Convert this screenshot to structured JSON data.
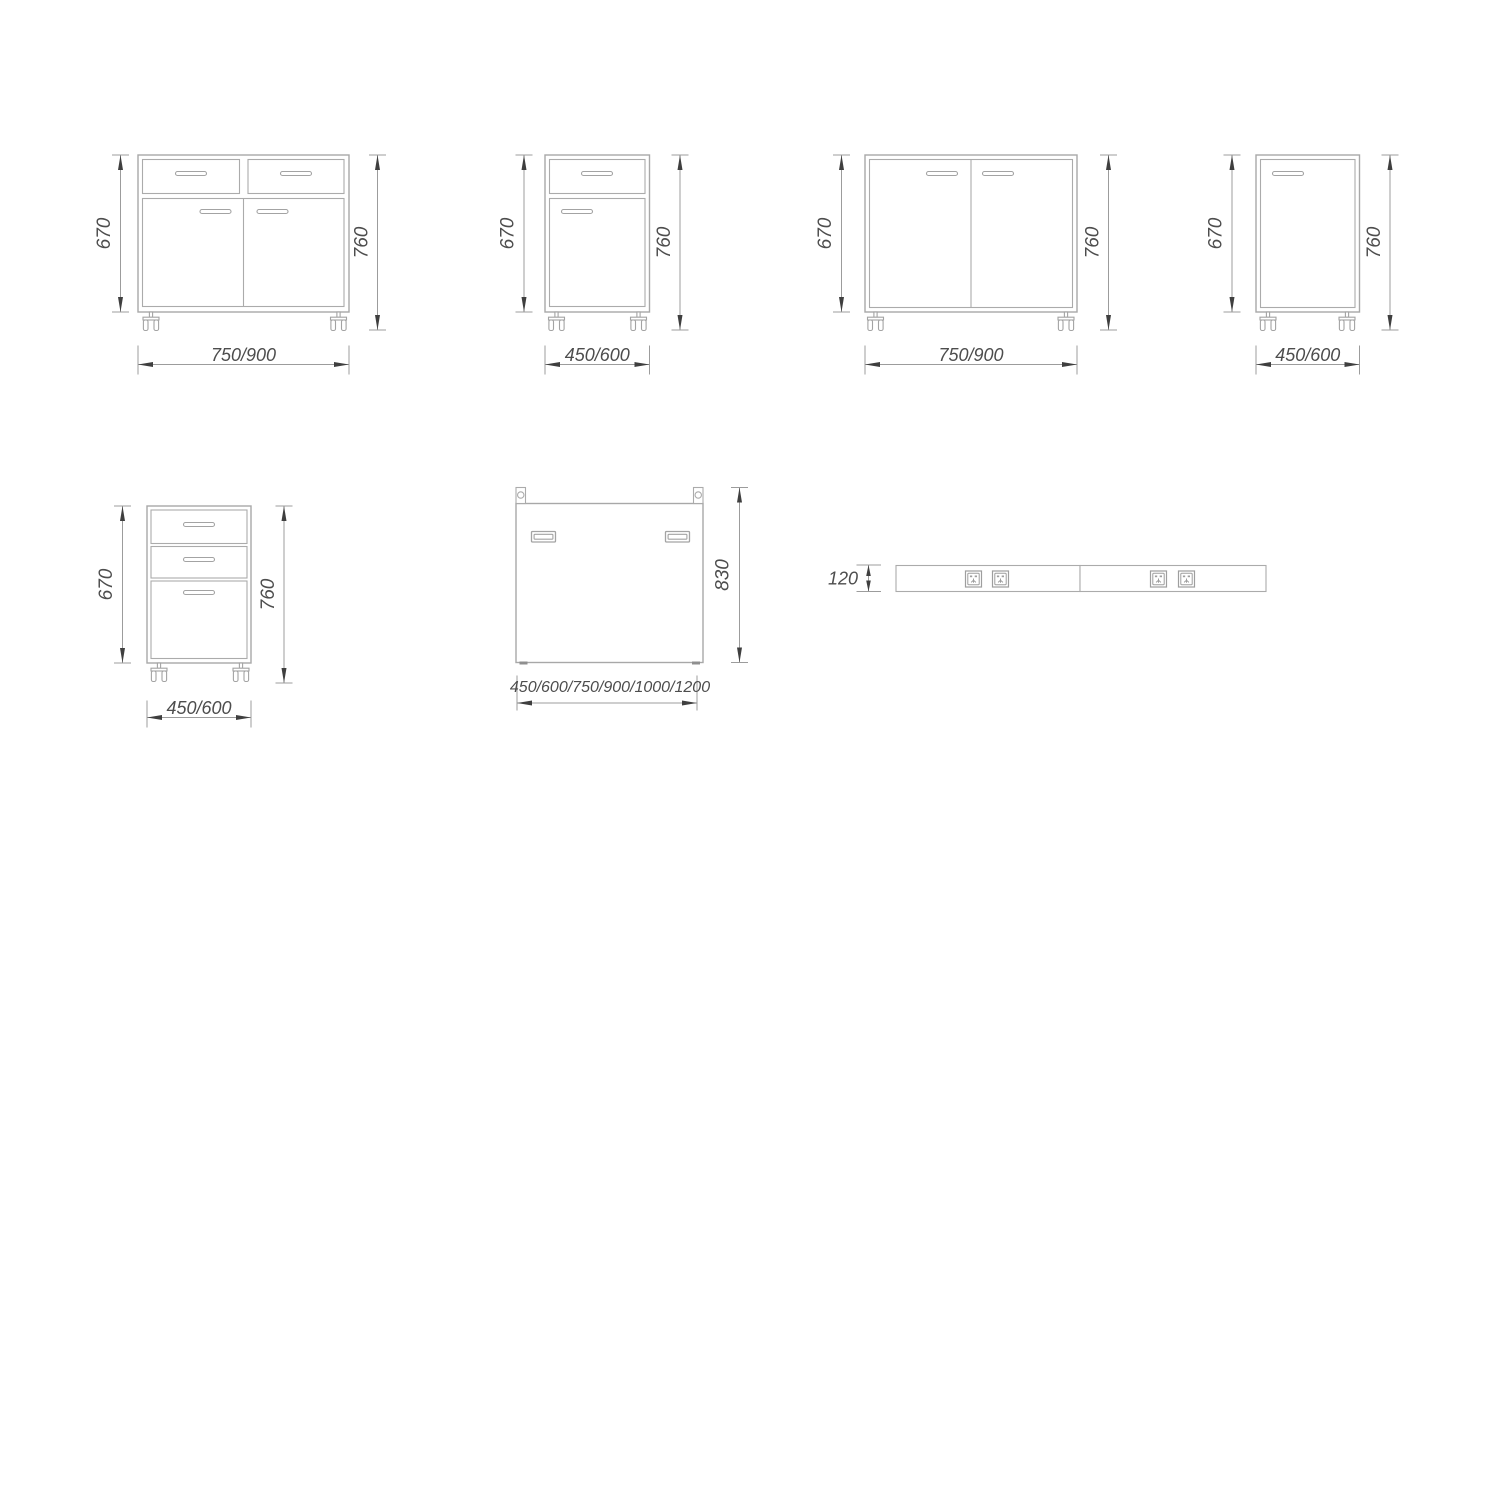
{
  "colors": {
    "background": "#ffffff",
    "drawing_line": "#a8a8a8",
    "dimension_line": "#9c9c9c",
    "arrow": "#3f3f3f",
    "text": "#4d4d4d"
  },
  "figures": {
    "cabinet_two_drawers_two_doors": {
      "body_height": "670",
      "overall_height": "760",
      "width_options": "750/900"
    },
    "cabinet_single_drawer_single_door": {
      "body_height": "670",
      "overall_height": "760",
      "width_options": "450/600"
    },
    "cabinet_double_door": {
      "body_height": "670",
      "overall_height": "760",
      "width_options": "750/900"
    },
    "cabinet_single_door": {
      "body_height": "670",
      "overall_height": "760",
      "width_options": "450/600"
    },
    "cabinet_three_drawers": {
      "body_height": "670",
      "overall_height": "760",
      "width_options": "450/600"
    },
    "mobile_panel": {
      "height": "830",
      "width_options": "450/600/750/900/1000/1200"
    },
    "power_strip": {
      "height": "120"
    }
  }
}
